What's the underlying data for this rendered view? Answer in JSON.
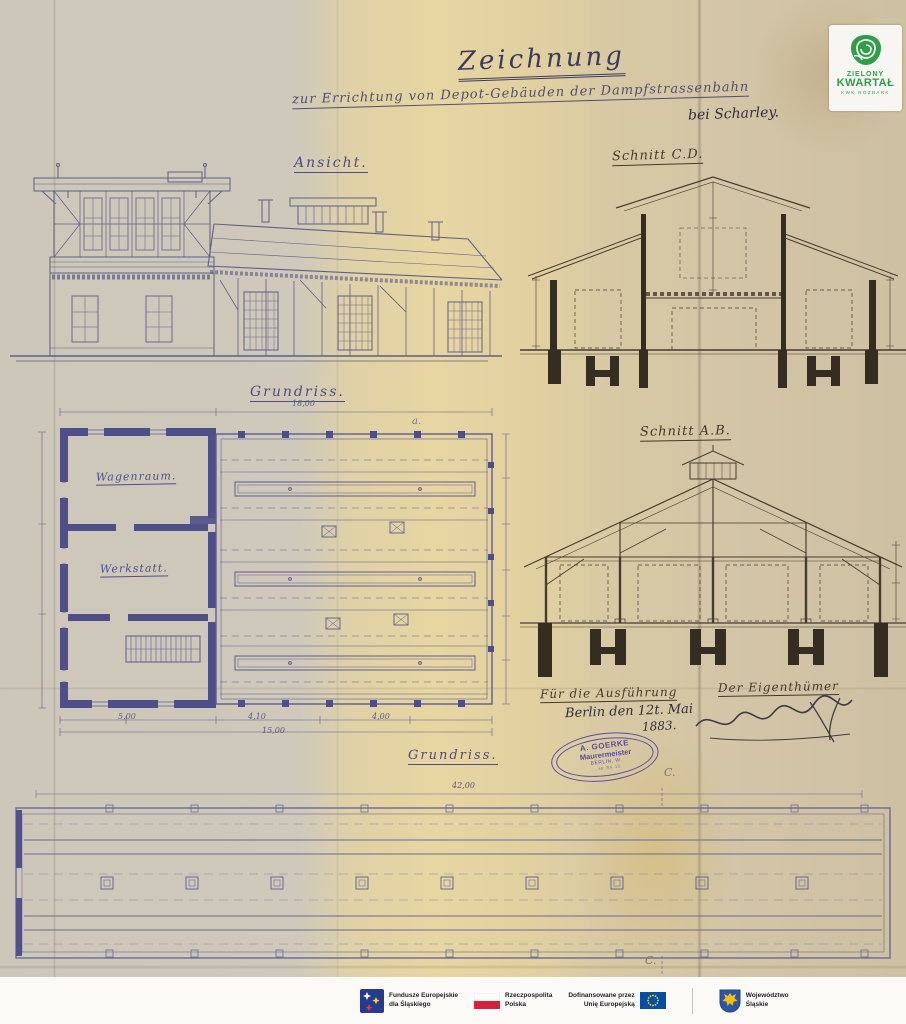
{
  "colors": {
    "badge_green": "#2f9e49",
    "ink_blue": "#4d4d80",
    "ink_brown": "#46392b",
    "stamp_purple": "#5b4ea2",
    "eu_blue": "#034ea2",
    "flag_red": "#d4213d"
  },
  "badge": {
    "line1": "ZIELONY",
    "line2": "KWARTAŁ",
    "line3": "KWK ROZBARK"
  },
  "title": {
    "main": "Zeichnung",
    "subtitle": "zur Errichtung von Depot-Gebäuden der Dampfstrassenbahn",
    "location": "bei Scharley."
  },
  "labels": {
    "ansicht": "Ansicht.",
    "schnitt_cd": "Schnitt C.D.",
    "grundriss_plan": "Grundriss.",
    "schnitt_ab": "Schnitt A.B.",
    "grundriss_bottom": "Grundriss.",
    "room_top": "Wagenraum.",
    "room_bottom": "Werkstatt."
  },
  "dimensions": {
    "plan_width_top": "18,00",
    "plan_bay_1": "5,00",
    "plan_bay_2": "4,10",
    "plan_bay_3": "4,00",
    "plan_total": "15,00",
    "track_plan_length": "42,00"
  },
  "marks": {
    "section_top": "C.",
    "section_bottom": "C.",
    "plan_mark": "a."
  },
  "approval": {
    "execution_heading": "Für die Ausführung",
    "owner_heading": "Der Eigenthümer",
    "place_date": "Berlin den 12t. Mai",
    "year": "1883."
  },
  "stamp": {
    "line1": "A. GOERKE",
    "line2": "Maurermeister",
    "line3": "BERLIN, W.",
    "line4": "…str. No. 13"
  },
  "footer": {
    "eu_program_line1": "Fundusze Europejskie",
    "eu_program_line2": "dla Śląskiego",
    "poland_line1": "Rzeczpospolita",
    "poland_line2": "Polska",
    "eu_funding_line1": "Dofinansowane przez",
    "eu_funding_line2": "Unię Europejską",
    "region_line1": "Województwo",
    "region_line2": "Śląskie"
  }
}
